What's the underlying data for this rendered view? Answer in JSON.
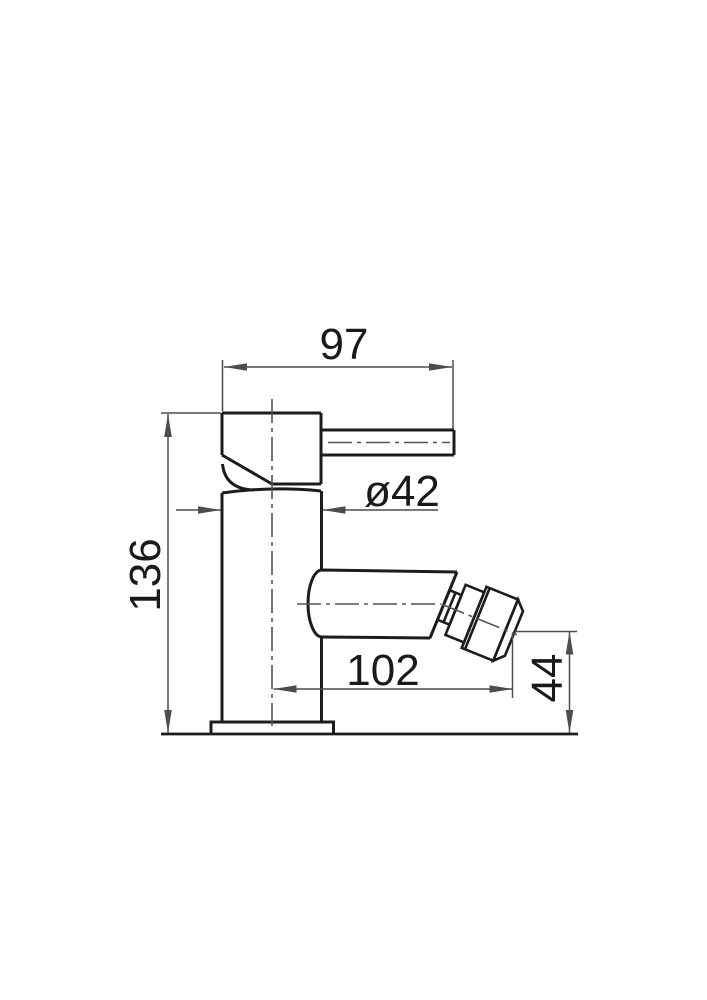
{
  "drawing": {
    "kind": "technical-drawing",
    "labels": {
      "width_top": "97",
      "diameter": "ø42",
      "height_total": "136",
      "width_bottom": "102",
      "height_outlet": "44"
    },
    "colors": {
      "outline": "#1c1c1c",
      "dimension": "#4d4d4d",
      "text": "#1a1a1a",
      "background": "#ffffff"
    }
  }
}
